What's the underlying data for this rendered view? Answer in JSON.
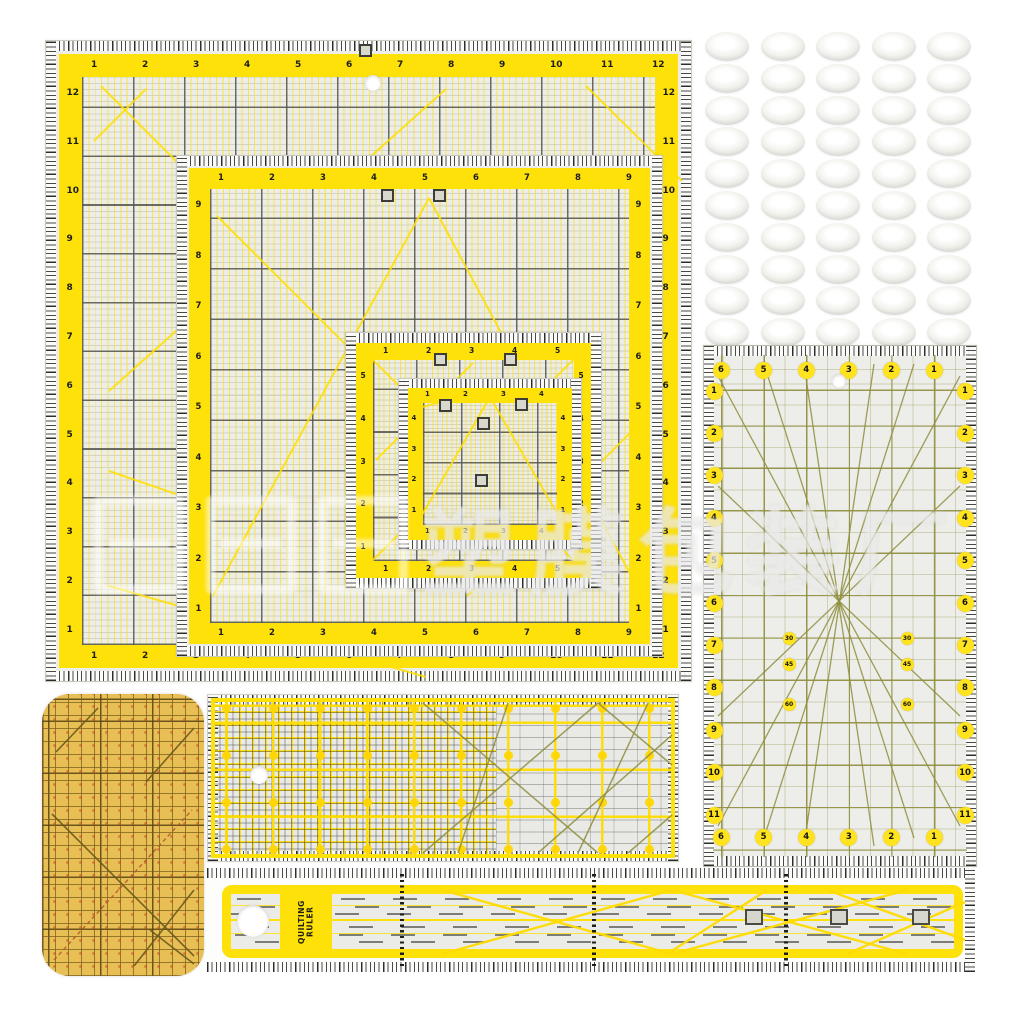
{
  "scene": {
    "description": "Product photo: acrylic quilting ruler set with yellow grid markings, non-slip grip discs and pressing ruler",
    "background": "#ffffff"
  },
  "colors": {
    "accent_yellow": "#FFE10A",
    "circle_yellow": "#FFE31E",
    "grid_dark": "#55554F",
    "grid_olive": "#8F8F3F",
    "body_gray": "#ECECE8",
    "tan_body": "#E8BF55",
    "tick_dark": "#2A2A28",
    "diag_yellow": "#FFE000"
  },
  "watermark": {
    "text": "塑膜包装厂"
  },
  "square_rulers": [
    {
      "top": [
        1,
        2,
        3,
        4,
        5,
        6,
        7,
        8,
        9,
        10,
        11,
        12
      ],
      "bottom": [
        1,
        2,
        3,
        4,
        5,
        6,
        7,
        8,
        9,
        10,
        11,
        12
      ],
      "left": [
        12,
        11,
        10,
        9,
        8,
        7,
        6,
        5,
        4,
        3,
        2,
        1
      ],
      "right": [
        12,
        11,
        10,
        9,
        8,
        7,
        6,
        5,
        4,
        3,
        2,
        1
      ]
    },
    {
      "top": [
        1,
        2,
        3,
        4,
        5,
        6,
        7,
        8,
        9
      ],
      "bottom": [
        1,
        2,
        3,
        4,
        5,
        6,
        7,
        8,
        9
      ],
      "left": [
        9,
        8,
        7,
        6,
        5,
        4,
        3,
        2,
        1
      ],
      "right": [
        9,
        8,
        7,
        6,
        5,
        4,
        3,
        2,
        1
      ]
    },
    {
      "top": [
        1,
        2,
        3,
        4,
        5
      ],
      "bottom": [
        1,
        2,
        3,
        4,
        5
      ],
      "left": [
        5,
        4,
        3,
        2,
        1
      ],
      "right": [
        5,
        4,
        3,
        2,
        1
      ]
    },
    {
      "top": [
        1,
        2,
        3,
        4
      ],
      "bottom": [
        1,
        2,
        3,
        4
      ],
      "left": [
        4,
        3,
        2,
        1
      ],
      "right": [
        4,
        3,
        2,
        1
      ]
    }
  ],
  "rect_ruler": {
    "top": [
      6,
      5,
      4,
      3,
      2,
      1
    ],
    "bottom": [
      6,
      5,
      4,
      3,
      2,
      1
    ],
    "left": [
      1,
      2,
      3,
      4,
      5,
      6,
      7,
      8,
      9,
      10,
      11
    ],
    "right": [
      1,
      2,
      3,
      4,
      5,
      6,
      7,
      8,
      9,
      10,
      11
    ],
    "angles": [
      "30",
      "45",
      "60"
    ]
  },
  "long_ruler": {
    "label": "QUILTING RULER"
  },
  "grip_discs": {
    "rows": 10,
    "cols": 5
  }
}
